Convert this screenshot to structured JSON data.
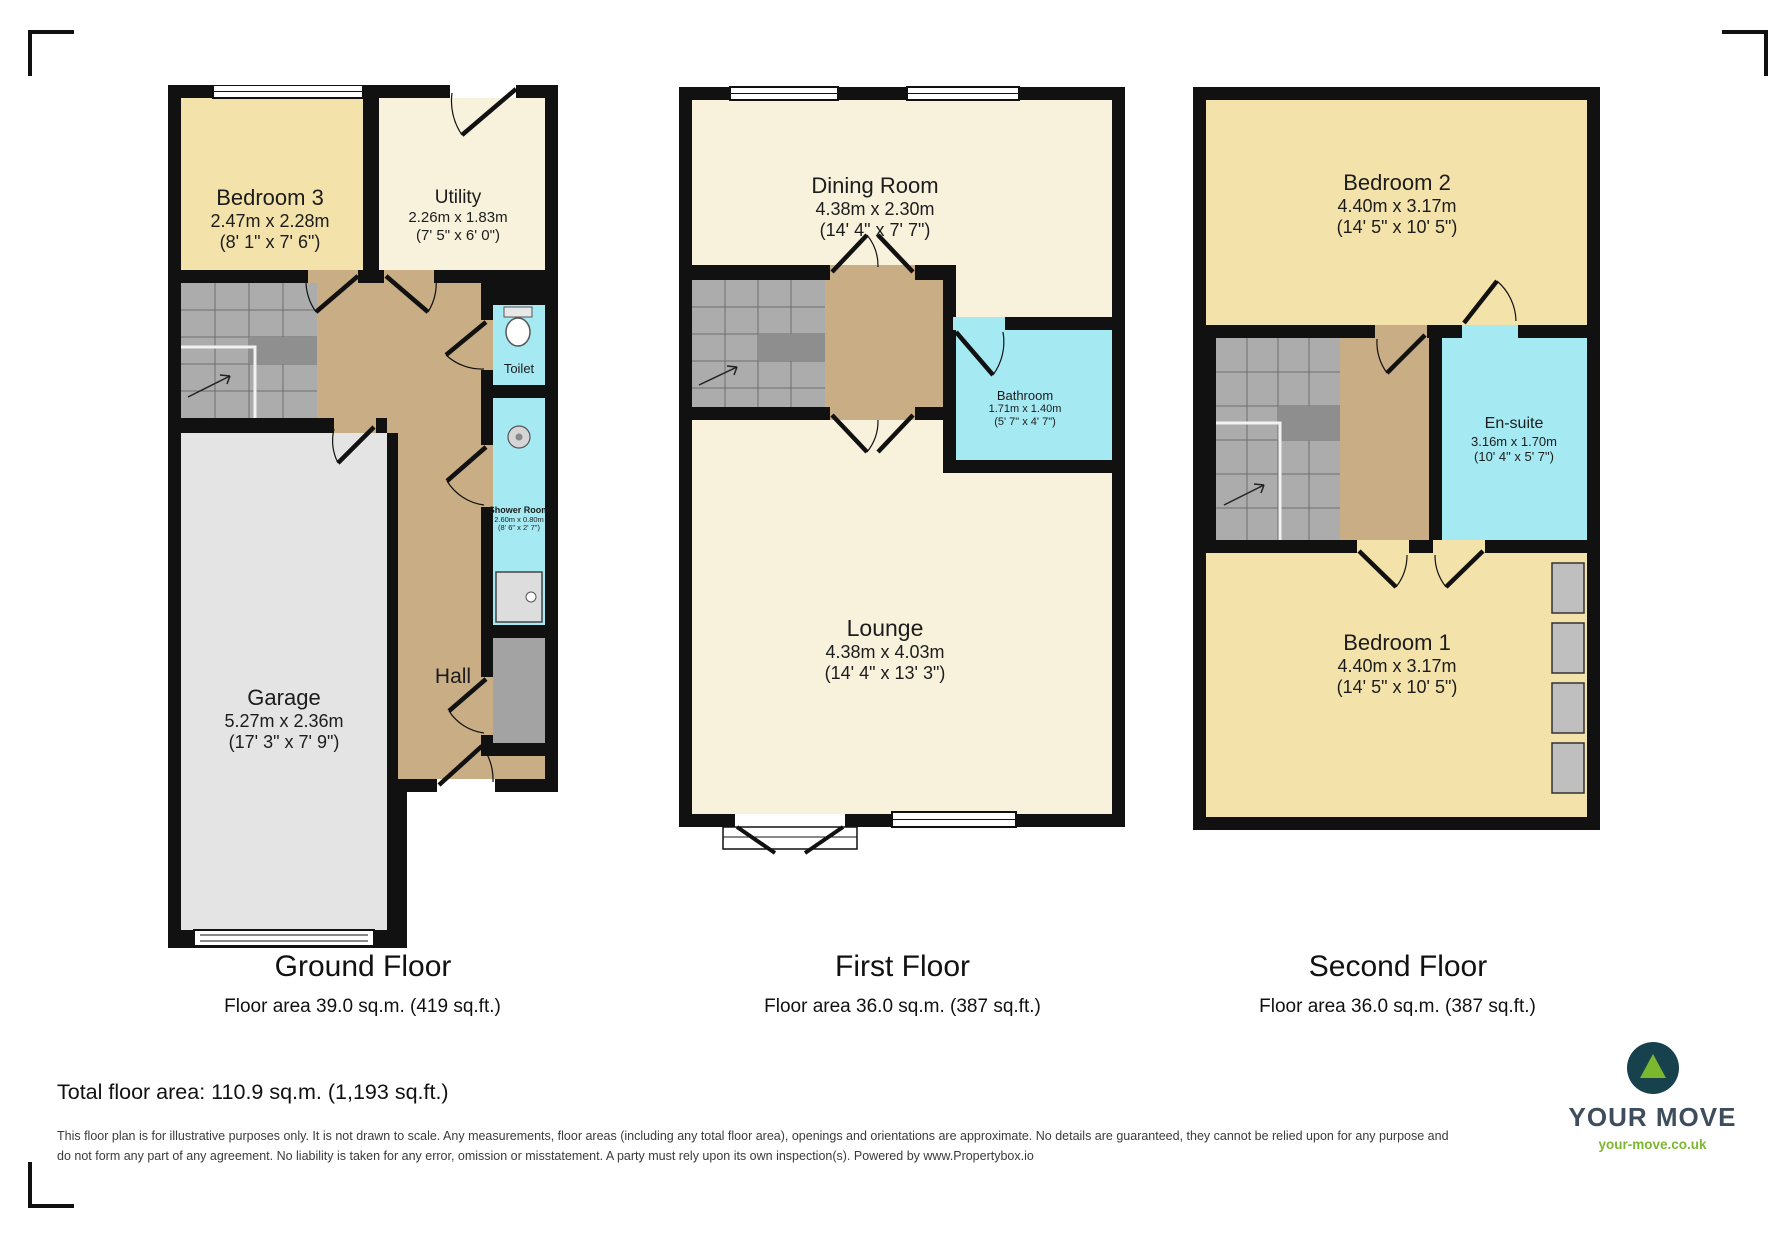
{
  "floors": [
    {
      "title": "Ground Floor",
      "area": "Floor area 39.0 sq.m. (419 sq.ft.)",
      "rooms": [
        {
          "name": "Bedroom 3",
          "dims_m": "2.47m x 2.28m",
          "dims_ft": "(8' 1\" x 7' 6\")"
        },
        {
          "name": "Utility",
          "dims_m": "2.26m x 1.83m",
          "dims_ft": "(7' 5\" x 6' 0\")"
        },
        {
          "name": "Toilet",
          "dims_m": "",
          "dims_ft": ""
        },
        {
          "name": "Shower Room",
          "dims_m": "2.60m x 0.80m",
          "dims_ft": "(8' 6\" x 2' 7\")"
        },
        {
          "name": "Hall",
          "dims_m": "",
          "dims_ft": ""
        },
        {
          "name": "Garage",
          "dims_m": "5.27m x 2.36m",
          "dims_ft": "(17' 3\" x 7' 9\")"
        }
      ]
    },
    {
      "title": "First Floor",
      "area": "Floor area 36.0 sq.m. (387 sq.ft.)",
      "rooms": [
        {
          "name": "Dining Room",
          "dims_m": "4.38m x 2.30m",
          "dims_ft": "(14' 4\" x 7' 7\")"
        },
        {
          "name": "Bathroom",
          "dims_m": "1.71m x 1.40m",
          "dims_ft": "(5' 7\" x 4' 7\")"
        },
        {
          "name": "Lounge",
          "dims_m": "4.38m x 4.03m",
          "dims_ft": "(14' 4\" x 13' 3\")"
        }
      ]
    },
    {
      "title": "Second Floor",
      "area": "Floor area 36.0 sq.m. (387 sq.ft.)",
      "rooms": [
        {
          "name": "Bedroom 2",
          "dims_m": "4.40m x 3.17m",
          "dims_ft": "(14' 5\" x 10' 5\")"
        },
        {
          "name": "En-suite",
          "dims_m": "3.16m x 1.70m",
          "dims_ft": "(10' 4\" x 5' 7\")"
        },
        {
          "name": "Bedroom 1",
          "dims_m": "4.40m x 3.17m",
          "dims_ft": "(14' 5\" x 10' 5\")"
        }
      ]
    }
  ],
  "summary": {
    "total_area": "Total floor area: 110.9 sq.m. (1,193 sq.ft.)"
  },
  "disclaimer": "This floor plan is for illustrative purposes only. It is not drawn to scale. Any measurements, floor areas (including any total floor area), openings and orientations are approximate. No details are guaranteed, they cannot be relied upon for any purpose and do not form any part of any agreement. No liability is taken for any error, omission or misstatement. A party must rely upon its own inspection(s). Powered by www.Propertybox.io",
  "logo": {
    "brand": "YOUR MOVE",
    "url": "your-move.co.uk"
  },
  "colors": {
    "wall": "#111111",
    "bedroom_yellow": "#F3E2A9",
    "cream": "#F8F1DC",
    "wet_room_cyan": "#A5E9F3",
    "hall_tan": "#C8AD85",
    "stairs_gray": "#ACACAC",
    "garage_gray": "#E4E4E4",
    "brand_dark": "#17414D",
    "brand_green": "#7CB82F"
  }
}
